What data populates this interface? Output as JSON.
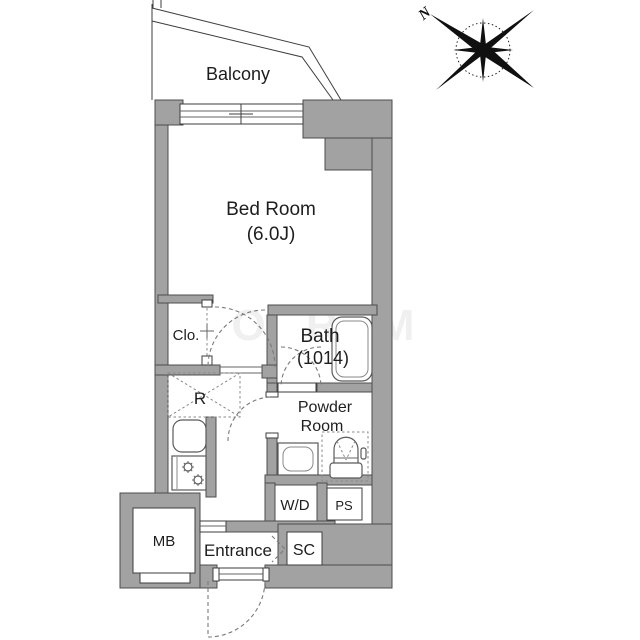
{
  "plan": {
    "labels": {
      "balcony": "Balcony",
      "bed_room": "Bed Room",
      "bed_room_size": "(6.0J)",
      "closet": "Clo.",
      "bath": "Bath",
      "bath_size": "(1014)",
      "refrigerator_space": "R",
      "powder_line1": "Powder",
      "powder_line2": "Room",
      "washer_dryer": "W/D",
      "pipe_space": "PS",
      "meter_box": "MB",
      "entrance": "Entrance",
      "shoe_closet": "SC"
    },
    "compass": {
      "north_label": "N"
    },
    "watermark": "O R M",
    "colors": {
      "wall_fill": "#a2a2a2",
      "wall_stroke": "#4c4c4c",
      "line": "#3d3d3d",
      "dashed_door": "#7a7a7a",
      "text": "#1e1e1e",
      "compass_ink": "#101010"
    }
  }
}
